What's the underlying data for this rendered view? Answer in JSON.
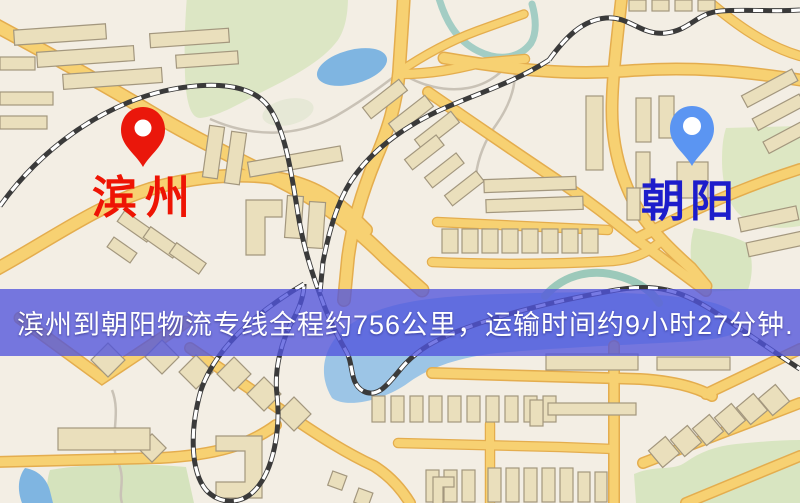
{
  "map": {
    "banner": {
      "text": "滨州到朝阳物流专线全程约756公里，运输时间约9小时27分钟.",
      "bg_color": "rgba(81,85,220,0.78)",
      "text_color": "#ffffff"
    },
    "origin": {
      "name": "滨州",
      "pin_color": "#ea170b",
      "pin_inner_color": "#ffffff",
      "label_color": "#ee1404"
    },
    "destination": {
      "name": "朝阳",
      "pin_color": "#5b95f2",
      "pin_inner_color": "#ffffff",
      "label_color": "#1d1dcb"
    }
  },
  "theme": {
    "background": "#f3eee4",
    "road_fill": "#f7d172",
    "road_casing": "#e4ad4e",
    "building_fill": "#eadfbc",
    "building_stroke": "#a3977e",
    "park_green": "#dce6c4",
    "water_blue": "#9cc5e6",
    "pond_blue": "#7fb5e1",
    "railway_dark": "#3a3a3a"
  }
}
